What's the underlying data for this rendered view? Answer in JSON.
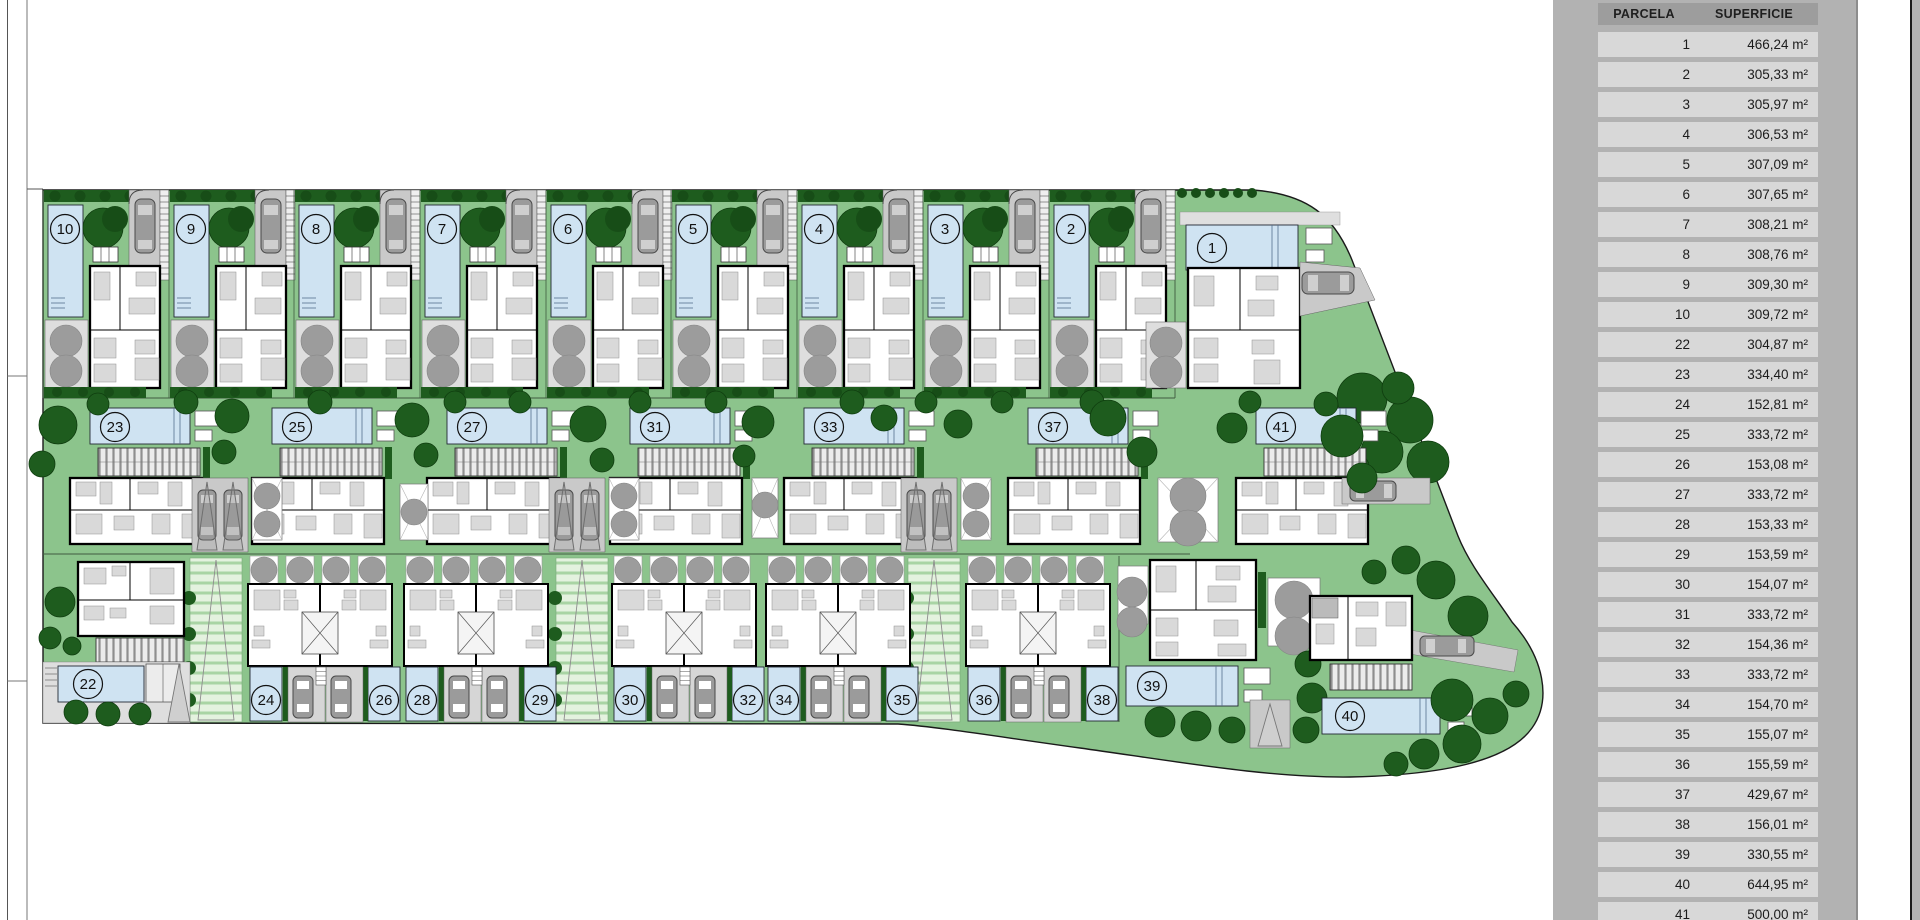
{
  "colors": {
    "lawn": "#8cc48c",
    "hedge": "#1e5c1e",
    "hedge_dark": "#174d17",
    "pool": "#cfe3f2",
    "pool_border": "#222833",
    "drive": "#c9c9c9",
    "car": "#9b9b9b",
    "terrace": "#dedede",
    "grey_tree": "#9c9c9c",
    "walk_bg": "#e4f2df",
    "walk_stripe": "#a9d4a4",
    "house_wall": "#000000",
    "furniture": "#d9d9d9",
    "panel": "#b2b2b2",
    "header_bg": "#9d9d9d",
    "row_bg": "#d8d8d8"
  },
  "table": {
    "headers": [
      "PARCELA",
      "SUPERFICIE"
    ],
    "rows": [
      {
        "parcela": "1",
        "superficie": "466,24 m²"
      },
      {
        "parcela": "2",
        "superficie": "305,33 m²"
      },
      {
        "parcela": "3",
        "superficie": "305,97 m²"
      },
      {
        "parcela": "4",
        "superficie": "306,53 m²"
      },
      {
        "parcela": "5",
        "superficie": "307,09 m²"
      },
      {
        "parcela": "6",
        "superficie": "307,65 m²"
      },
      {
        "parcela": "7",
        "superficie": "308,21 m²"
      },
      {
        "parcela": "8",
        "superficie": "308,76 m²"
      },
      {
        "parcela": "9",
        "superficie": "309,30 m²"
      },
      {
        "parcela": "10",
        "superficie": "309,72 m²"
      },
      {
        "parcela": "22",
        "superficie": "304,87 m²"
      },
      {
        "parcela": "23",
        "superficie": "334,40 m²"
      },
      {
        "parcela": "24",
        "superficie": "152,81 m²"
      },
      {
        "parcela": "25",
        "superficie": "333,72 m²"
      },
      {
        "parcela": "26",
        "superficie": "153,08 m²"
      },
      {
        "parcela": "27",
        "superficie": "333,72 m²"
      },
      {
        "parcela": "28",
        "superficie": "153,33 m²"
      },
      {
        "parcela": "29",
        "superficie": "153,59 m²"
      },
      {
        "parcela": "30",
        "superficie": "154,07 m²"
      },
      {
        "parcela": "31",
        "superficie": "333,72 m²"
      },
      {
        "parcela": "32",
        "superficie": "154,36 m²"
      },
      {
        "parcela": "33",
        "superficie": "333,72 m²"
      },
      {
        "parcela": "34",
        "superficie": "154,70 m²"
      },
      {
        "parcela": "35",
        "superficie": "155,07 m²"
      },
      {
        "parcela": "36",
        "superficie": "155,59 m²"
      },
      {
        "parcela": "37",
        "superficie": "429,67 m²"
      },
      {
        "parcela": "38",
        "superficie": "156,01 m²"
      },
      {
        "parcela": "39",
        "superficie": "330,55 m²"
      },
      {
        "parcela": "40",
        "superficie": "644,95 m²"
      },
      {
        "parcela": "41",
        "superficie": "500,00 m²"
      }
    ]
  },
  "plan": {
    "top_row": [
      {
        "id": "10",
        "x": 43
      },
      {
        "id": "9",
        "x": 169
      },
      {
        "id": "8",
        "x": 294
      },
      {
        "id": "7",
        "x": 420
      },
      {
        "id": "6",
        "x": 546
      },
      {
        "id": "5",
        "x": 671
      },
      {
        "id": "4",
        "x": 797
      },
      {
        "id": "3",
        "x": 923
      },
      {
        "id": "2",
        "x": 1049
      }
    ],
    "corner_villa": {
      "id": "1"
    },
    "mid_row": [
      {
        "id": "23",
        "x": 90
      },
      {
        "id": "25",
        "x": 272
      },
      {
        "id": "27",
        "x": 447
      },
      {
        "id": "31",
        "x": 630
      },
      {
        "id": "33",
        "x": 804
      },
      {
        "id": "37",
        "x": 1028
      },
      {
        "id": "41",
        "x": 1256
      }
    ],
    "duplex_row": [
      {
        "left": "24",
        "right": "26",
        "x": 240
      },
      {
        "left": "28",
        "right": "29",
        "x": 396
      },
      {
        "left": "30",
        "right": "32",
        "x": 604
      },
      {
        "left": "34",
        "right": "35",
        "x": 758
      },
      {
        "left": "36",
        "right": "38",
        "x": 958
      }
    ],
    "villa_22": {
      "id": "22"
    },
    "villa_39": {
      "id": "39"
    },
    "villa_40": {
      "id": "40"
    }
  }
}
